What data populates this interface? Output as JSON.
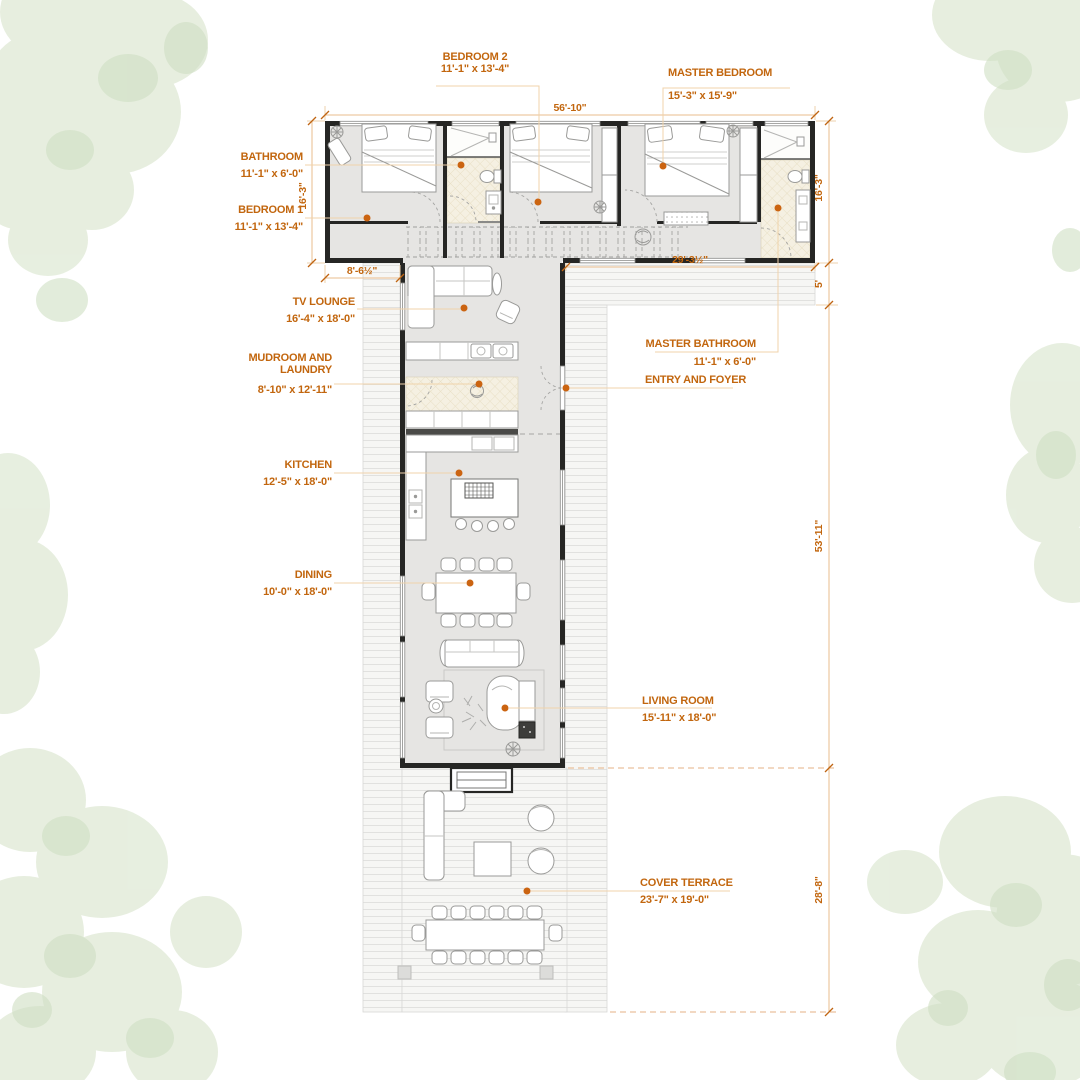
{
  "title": "L-shaped house floor plan",
  "colors": {
    "accent_text": "#c2660e",
    "leader_dot": "#cb6411",
    "leader_line": "#f0d3ab",
    "dimension_line": "#e9bc8c",
    "wall": "#262624",
    "floor": "#e6e5e3",
    "bath_floor": "#f5f0e2",
    "deck_stripe": "#e1e1df",
    "landscape_green": "#dfe9d6"
  },
  "rooms": [
    {
      "id": "bedroom-2",
      "name": "BEDROOM 2",
      "size": "11'-1\" x 13'-4\""
    },
    {
      "id": "master-bedroom",
      "name": "MASTER BEDROOM",
      "size": "15'-3\" x 15'-9\""
    },
    {
      "id": "bathroom",
      "name": "BATHROOM",
      "size": "11'-1\" x 6'-0\""
    },
    {
      "id": "bedroom-1",
      "name": "BEDROOM 1",
      "size": "11'-1\" x 13'-4\""
    },
    {
      "id": "tv-lounge",
      "name": "TV LOUNGE",
      "size": "16'-4\" x 18'-0\""
    },
    {
      "id": "mudroom-laundry",
      "name": "MUDROOM AND LAUNDRY",
      "size": "8'-10\" x 12'-11\""
    },
    {
      "id": "kitchen",
      "name": "KITCHEN",
      "size": "12'-5\" x 18'-0\""
    },
    {
      "id": "dining",
      "name": "DINING",
      "size": "10'-0\" x 18'-0\""
    },
    {
      "id": "master-bathroom",
      "name": "MASTER BATHROOM",
      "size": "11'-1\" x 6'-0\""
    },
    {
      "id": "entry-foyer",
      "name": "ENTRY AND FOYER",
      "size": ""
    },
    {
      "id": "living-room",
      "name": "LIVING ROOM",
      "size": "15'-11\" x 18'-0\""
    },
    {
      "id": "cover-terrace",
      "name": "COVER TERRACE",
      "size": "23'-7\" x 19'-0\""
    }
  ],
  "dimensions": {
    "top_width": "56'-10\"",
    "left_height": "16'-3\"",
    "right_height": "16'-3\"",
    "left_porch": "8'-6½\"",
    "master_span": "29'-3½\"",
    "deck_depth": "5'",
    "wing_height": "53'-11\"",
    "terrace_height": "28'-8\""
  }
}
